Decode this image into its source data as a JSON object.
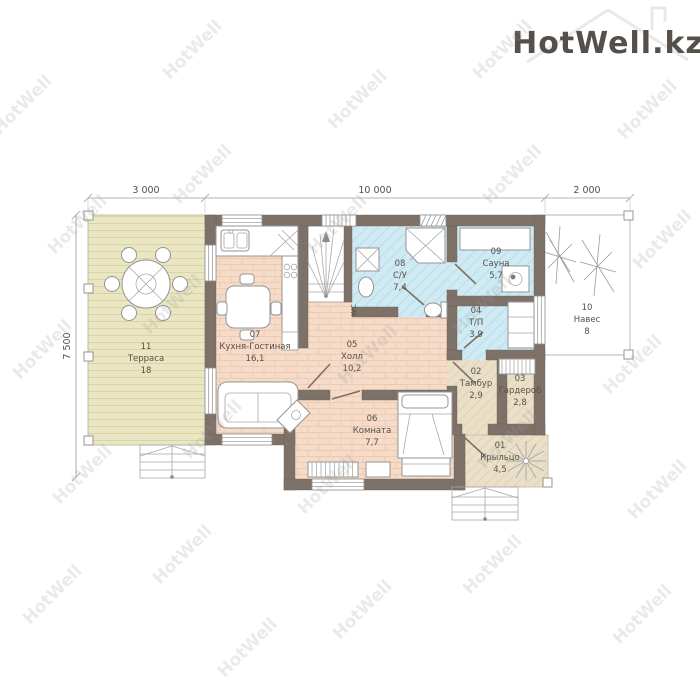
{
  "watermark": {
    "text": "HotWell"
  },
  "logo": {
    "text": "HotWell.kz"
  },
  "dimensions": {
    "top": [
      "3 000",
      "10 000",
      "2 000"
    ],
    "left": "7 500"
  },
  "rooms": [
    {
      "id": "01",
      "name": "Крыльцо",
      "area": "4,5"
    },
    {
      "id": "02",
      "name": "Тамбур",
      "area": "2,9"
    },
    {
      "id": "03",
      "name": "Гардероб",
      "area": "2,8"
    },
    {
      "id": "04",
      "name": "Т/П",
      "area": "3,9"
    },
    {
      "id": "05",
      "name": "Холл",
      "area": "10,2"
    },
    {
      "id": "06",
      "name": "Комната",
      "area": "7,7"
    },
    {
      "id": "07",
      "name": "Кухня-Гостиная",
      "area": "16,1"
    },
    {
      "id": "08",
      "name": "С/У",
      "area": "7,4"
    },
    {
      "id": "09",
      "name": "Сауна",
      "area": "5,7"
    },
    {
      "id": "10",
      "name": "Навес",
      "area": "8"
    },
    {
      "id": "11",
      "name": "Терраса",
      "area": "18"
    }
  ],
  "labels": {
    "wc": "WC"
  },
  "colors": {
    "wall": "#7e7168",
    "floor_wood": "#f6dbc8",
    "floor_tile": "#cfeaf3",
    "floor_outdoor": "#eae0c8",
    "floor_terrace": "#eae6c2",
    "watermark": "#9a9a9a",
    "label_text": "#56504a"
  }
}
